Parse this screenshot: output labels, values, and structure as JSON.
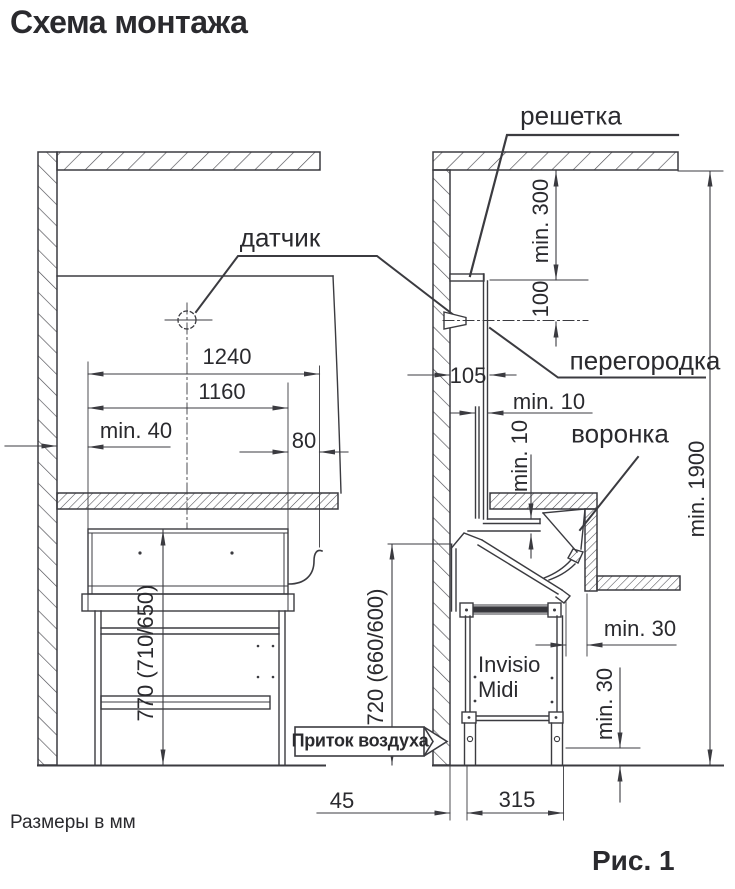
{
  "page": {
    "title": "Схема монтажа",
    "units_note": "Размеры в мм",
    "caption": "Рис. 1"
  },
  "labels": {
    "sensor": "датчик",
    "grille": "решетка",
    "partition": "перегородка",
    "funnel": "воронка",
    "air_inflow": "Приток воздуха",
    "unit_line1": "Invisio",
    "unit_line2": "Midi"
  },
  "dimensions": {
    "overall_width": "1240",
    "inner_width": "1160",
    "min_side_clearance": "min. 40",
    "outlet_offset": "80",
    "grille_to_ceiling": "min. 300",
    "sensor_below_grille": "100",
    "wall_to_partition": "105",
    "partition_gap_horizontal": "min. 10",
    "partition_gap_vertical": "min. 10",
    "floor_to_ceiling": "min. 1900",
    "hob_top_height": "770 (710/650)",
    "unit_top_height": "720 (660/600)",
    "unit_to_counter": "min. 30",
    "foot_clearance": "min. 30",
    "wall_to_unit": "45",
    "unit_base_width": "315"
  },
  "colors": {
    "line": "#3b3b40",
    "text": "#2a2a2e",
    "background": "#ffffff"
  }
}
